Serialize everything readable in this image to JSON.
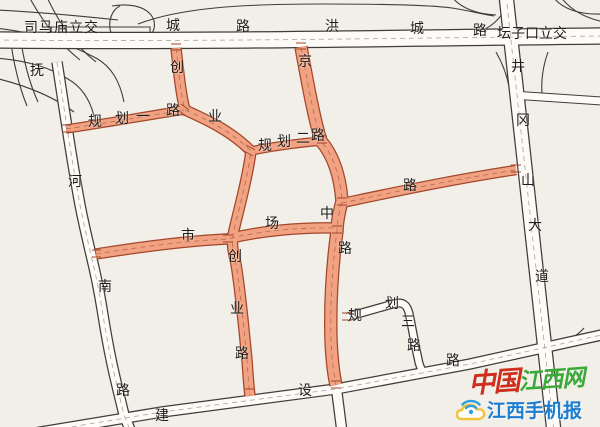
{
  "map": {
    "colors": {
      "bg": "#f2efe8",
      "road-fill": "#fcfbf7",
      "road-stroke": "#3f3d3a",
      "hl-fill": "#f1a282",
      "hl-stroke": "#a4462a",
      "center-line": "#a9a49c",
      "hl-center": "#b96a4a",
      "label": "#1f1d1b"
    },
    "road_names": [
      "洪城路",
      "抚河南路",
      "井冈山大道",
      "建设路",
      "创业路",
      "市场路",
      "规划一路",
      "规划二路",
      "规划三路"
    ],
    "interchanges": [
      "司马庙立交",
      "坛子口立交"
    ],
    "labels": [
      {
        "t": "司马庙立交",
        "x": 24,
        "y": 21,
        "ls": 1
      },
      {
        "t": "城",
        "x": 166,
        "y": 19
      },
      {
        "t": "路",
        "x": 236,
        "y": 20
      },
      {
        "t": "洪",
        "x": 325,
        "y": 20
      },
      {
        "t": "城",
        "x": 410,
        "y": 22
      },
      {
        "t": "路",
        "x": 473,
        "y": 24
      },
      {
        "t": "坛子口立交",
        "x": 497,
        "y": 27,
        "ls": 0
      },
      {
        "t": "创",
        "x": 170,
        "y": 61
      },
      {
        "t": "业",
        "x": 208,
        "y": 110
      },
      {
        "t": "规",
        "x": 88,
        "y": 115
      },
      {
        "t": "划",
        "x": 115,
        "y": 112
      },
      {
        "t": "一",
        "x": 136,
        "y": 110
      },
      {
        "t": "路",
        "x": 166,
        "y": 104
      },
      {
        "t": "京",
        "x": 298,
        "y": 55
      },
      {
        "t": "规",
        "x": 258,
        "y": 139
      },
      {
        "t": "划",
        "x": 277,
        "y": 135
      },
      {
        "t": "二",
        "x": 296,
        "y": 132
      },
      {
        "t": "路",
        "x": 311,
        "y": 129
      },
      {
        "t": "路",
        "x": 403,
        "y": 179
      },
      {
        "t": "井",
        "x": 511,
        "y": 60
      },
      {
        "t": "冈",
        "x": 516,
        "y": 114
      },
      {
        "t": "山",
        "x": 521,
        "y": 174
      },
      {
        "t": "大",
        "x": 528,
        "y": 219
      },
      {
        "t": "道",
        "x": 535,
        "y": 270
      },
      {
        "t": "抚",
        "x": 30,
        "y": 64
      },
      {
        "t": "河",
        "x": 68,
        "y": 175
      },
      {
        "t": "南",
        "x": 98,
        "y": 280
      },
      {
        "t": "路",
        "x": 116,
        "y": 384
      },
      {
        "t": "中",
        "x": 320,
        "y": 207
      },
      {
        "t": "路",
        "x": 338,
        "y": 242
      },
      {
        "t": "市",
        "x": 181,
        "y": 229
      },
      {
        "t": "场",
        "x": 265,
        "y": 217
      },
      {
        "t": "创",
        "x": 228,
        "y": 250
      },
      {
        "t": "业",
        "x": 230,
        "y": 302
      },
      {
        "t": "路",
        "x": 235,
        "y": 347
      },
      {
        "t": "规",
        "x": 348,
        "y": 309
      },
      {
        "t": "划",
        "x": 385,
        "y": 297
      },
      {
        "t": "三",
        "x": 401,
        "y": 315
      },
      {
        "t": "路",
        "x": 407,
        "y": 339
      },
      {
        "t": "建",
        "x": 155,
        "y": 409
      },
      {
        "t": "设",
        "x": 298,
        "y": 384
      },
      {
        "t": "路",
        "x": 446,
        "y": 354
      }
    ]
  },
  "watermark": {
    "brand_cn": "中国",
    "brand_site": "江西网",
    "app_name": "江西手机报"
  }
}
